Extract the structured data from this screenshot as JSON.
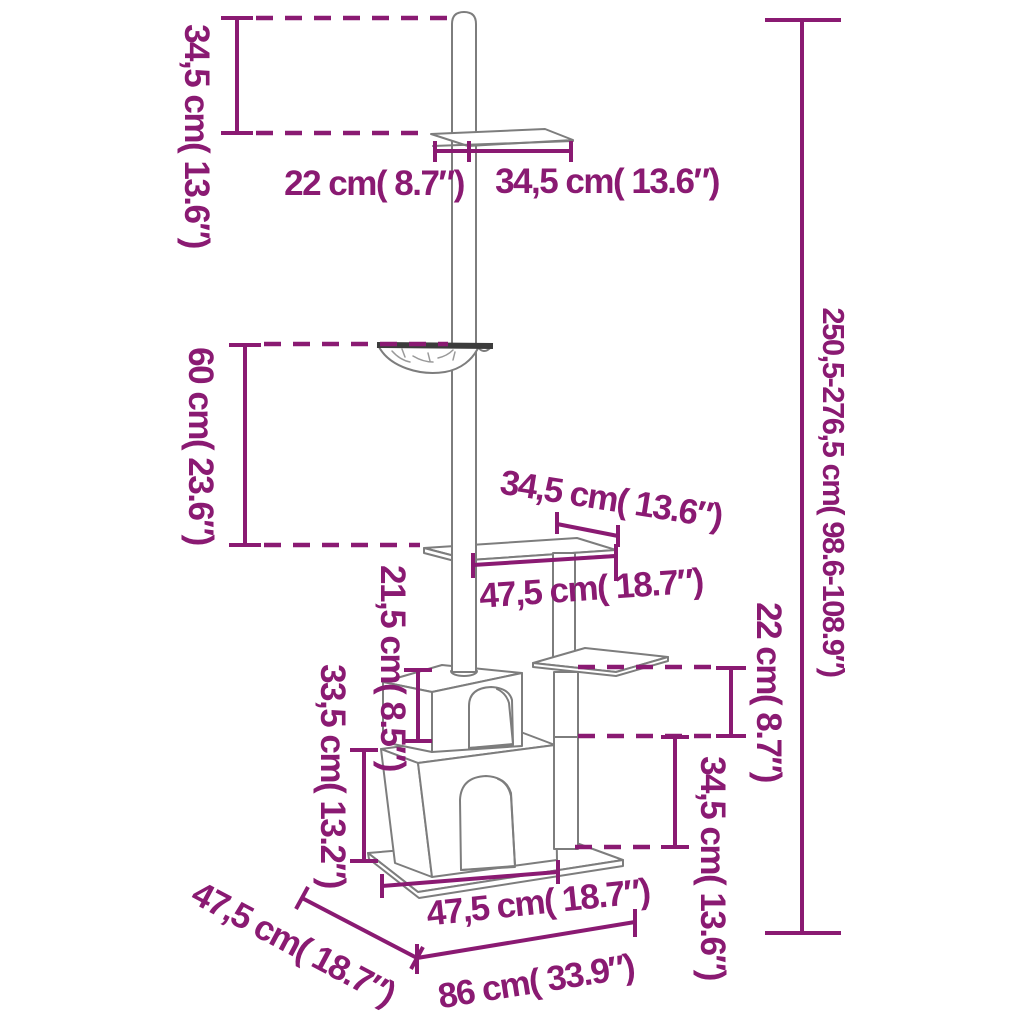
{
  "diagram": {
    "type": "product-dimension-diagram",
    "subject": "floor-to-ceiling cat tree with scratching posts, hammock, shelves and two condo houses",
    "colors": {
      "accent": "#8a1a72",
      "outline": "#7d7d7d",
      "hammock_rim": "#3c3c3c",
      "background": "#ffffff"
    },
    "labels": {
      "top_height": "34,5 cm( 13.6″)",
      "top_shelf_left": "22 cm( 8.7″)",
      "top_shelf_right": "34,5 cm( 13.6″)",
      "hammock_height": "60 cm( 23.6″)",
      "total_height": "250,5-276,5 cm( 98.6-108.9″)",
      "mid_shelf_depth": "34,5 cm( 13.6″)",
      "mid_shelf_width": "47,5 cm( 18.7″)",
      "cube_height": "21,5 cm( 8.5″)",
      "house_height": "33,5 cm( 13.2″)",
      "side_shelf_height": "22 cm( 8.7″)",
      "side_lower_height": "34,5 cm( 13.6″)",
      "base_depth": "47,5 cm( 18.7″)",
      "base_front_width": "47,5 cm( 18.7″)",
      "base_total_width": "86 cm( 33.9″)"
    }
  }
}
